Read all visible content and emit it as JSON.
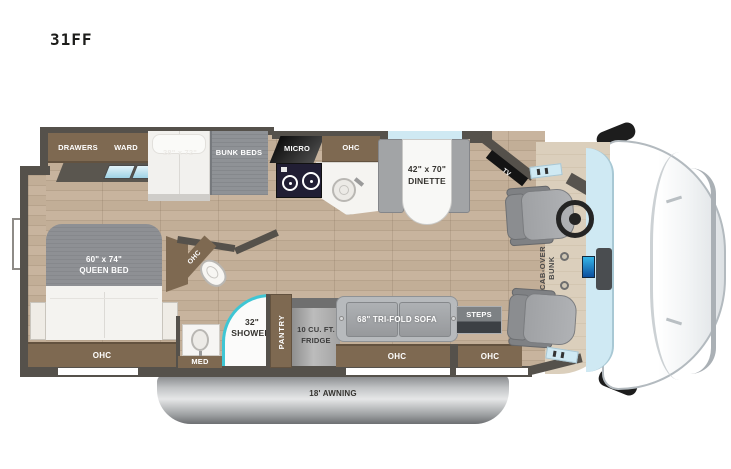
{
  "title": "31FF",
  "plan": {
    "slideout": {
      "drawers": "DRAWERS",
      "ward": "WARD",
      "bunk_dim": "28\" x 72\"",
      "bunk": "BUNK BEDS"
    },
    "kitchen": {
      "micro": "MICRO",
      "ohc": "OHC"
    },
    "dinette": {
      "dim": "42\" x 70\"",
      "name": "DINETTE"
    },
    "bedroom": {
      "dim": "60\" x 74\"",
      "name": "QUEEN BED",
      "ohc": "OHC"
    },
    "bath": {
      "ohc": "OHC",
      "shower_dim": "32\"",
      "shower": "SHOWER",
      "med": "MED"
    },
    "galley": {
      "pantry": "PANTRY",
      "fridge_line1": "10 CU. FT.",
      "fridge_line2": "FRIDGE"
    },
    "living": {
      "sofa": "68\" TRI-FOLD SOFA",
      "sofa_ohc": "OHC",
      "steps": "STEPS",
      "entry_ohc": "OHC"
    },
    "cab": {
      "tv": "TV",
      "bunk_line1": "CAB-OVER",
      "bunk_line2": "BUNK"
    },
    "awning": "18' AWNING"
  },
  "colors": {
    "wall": "#55514b",
    "cabinet": "#7e6951",
    "floor": "#c6b29b",
    "shower_glass": "#3fc6d4",
    "windshield": "#cfe9f3",
    "drawer_front": "#bfe3ef"
  }
}
